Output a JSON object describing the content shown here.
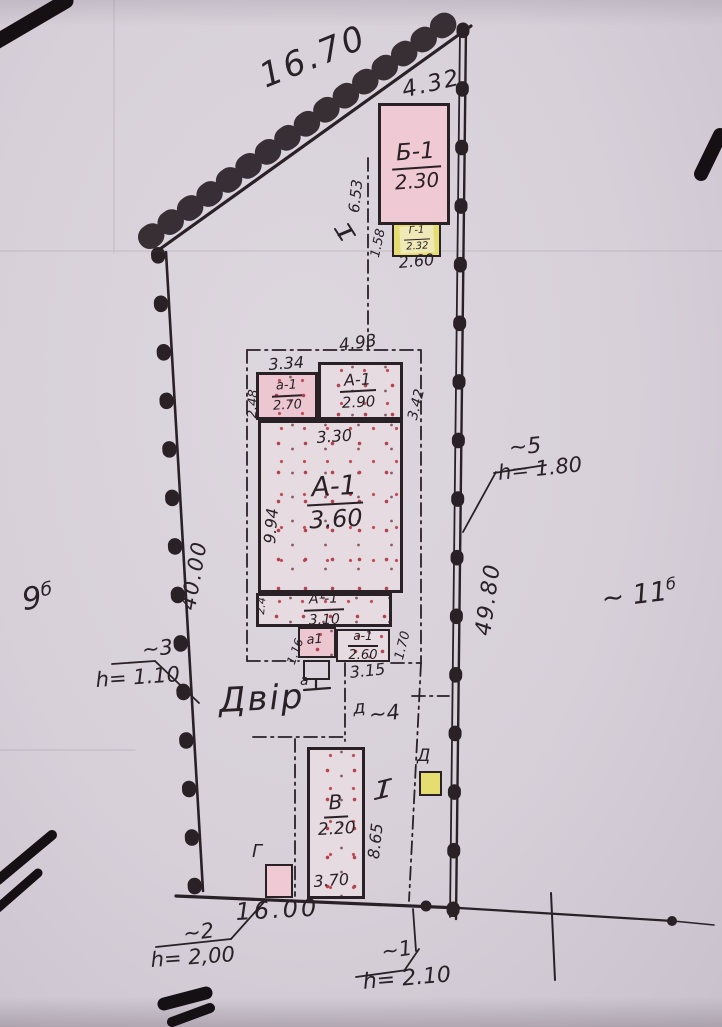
{
  "site": {
    "boundary_dims": {
      "top": "16.70",
      "top_right": "4.32",
      "left": "40.00",
      "right": "49.80",
      "bottom": "16.00"
    },
    "plot_labels": {
      "left_num": "9",
      "left_sup": "б",
      "right_num": "~ 11",
      "right_sup": "б"
    },
    "yard_label": "Двір"
  },
  "buildings": {
    "B1": {
      "name": "Б-1",
      "height": "2.30"
    },
    "G1": {
      "name": "Г-1",
      "height": "2.32"
    },
    "A1_upper_left": {
      "name": "а-1",
      "height": "2.70"
    },
    "A1_upper": {
      "name": "А-1",
      "height": "2.90"
    },
    "A1_main": {
      "name": "А-1",
      "height": "3.60"
    },
    "A1_rear": {
      "name": "А¹-1",
      "height": "3.10"
    },
    "a1_small": {
      "name": "а1"
    },
    "a1_right": {
      "name": "а-1",
      "height": "2.60"
    },
    "porch": {
      "name": "а"
    },
    "V": {
      "name": "В",
      "height": "2.20"
    },
    "G_shed": {
      "name": "Г"
    },
    "D_shed": {
      "name": "Д"
    }
  },
  "dims": {
    "d653": "6.53",
    "d158": "1.58",
    "d260_top": "2.60",
    "d493": "4.93",
    "d334": "3.34",
    "d248": "2.48",
    "d342": "3.42",
    "d330": "3.30",
    "d994": "9.94",
    "d24": "2.4",
    "d116": "1.16",
    "d170": "1.70",
    "d315": "3.15",
    "d865": "8.65",
    "d370": "3.70"
  },
  "fence_marks": {
    "m1": {
      "num": "~1",
      "h": "h= 2.10"
    },
    "m2": {
      "num": "~2",
      "h": "h= 2,00"
    },
    "m3": {
      "num": "~3",
      "h": "h= 1.10"
    },
    "m4": {
      "pre": "д",
      "num": "~4"
    },
    "m5": {
      "num": "~5",
      "h": "h= 1.80"
    }
  },
  "section_marks": {
    "top": "I",
    "bottom": "I"
  },
  "colors": {
    "ink": "#2a2127",
    "paper": "#d7d0d9",
    "building_pink": "#efc9d4",
    "building_yellow": "#e6dd70",
    "stipple_red": "#b2434e"
  }
}
